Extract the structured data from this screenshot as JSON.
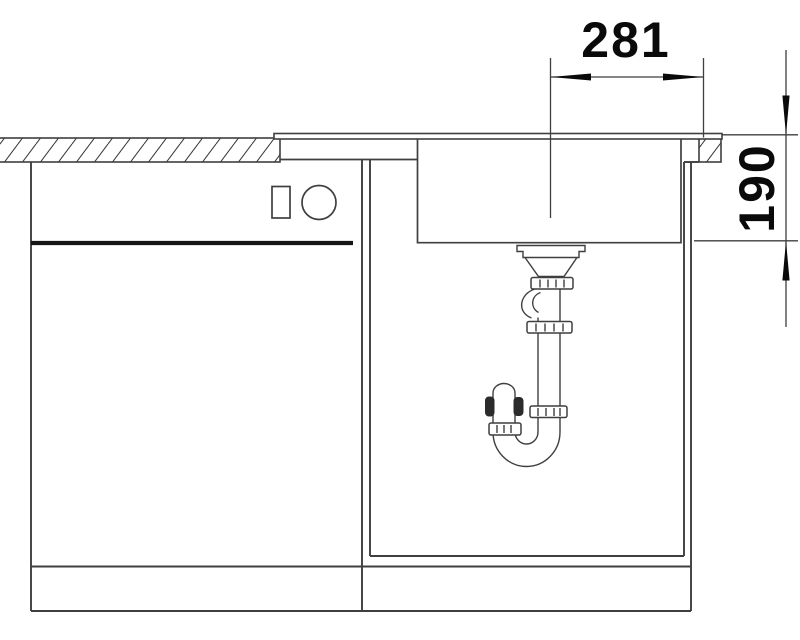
{
  "dimensions": {
    "bowl_center_to_worktop_edge": {
      "label": "281"
    },
    "bowl_depth": {
      "label": "190"
    }
  },
  "colors": {
    "background": "#ffffff",
    "line": "#3f3f3f",
    "thick_line": "#151515",
    "dimension_text": "#0a0a0a",
    "trap_dark": "#2b2b2b"
  }
}
